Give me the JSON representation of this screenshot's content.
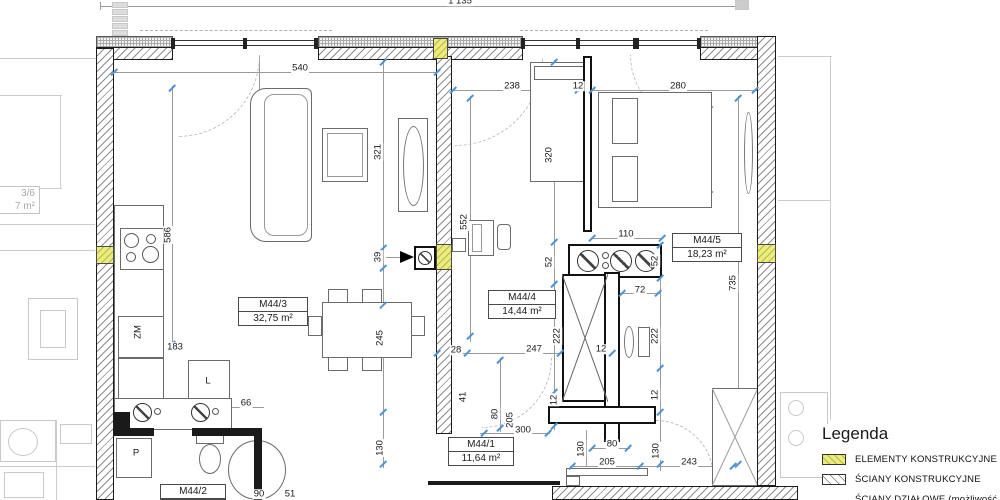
{
  "legend": {
    "title": "Legenda",
    "items": [
      {
        "label": "ELEMENTY KONSTRUKCYJNE",
        "swatch": "yellow-hatch"
      },
      {
        "label": "ŚCIANY KONSTRUKCYJNE",
        "swatch": "diagonal-hatch"
      },
      {
        "label": "ŚCIANY DZIAŁOWE (możliwość aranżacji)",
        "swatch": "light-hatch"
      }
    ]
  },
  "rooms": {
    "r1": {
      "name": "M44/1",
      "area": "11,64 m²"
    },
    "r2": {
      "name": "M44/2",
      "area": ""
    },
    "r3": {
      "name": "M44/3",
      "area": "32,75 m²"
    },
    "r4": {
      "name": "M44/4",
      "area": "14,44 m²"
    },
    "r5": {
      "name": "M44/5",
      "area": "18,23 m²"
    }
  },
  "neighbor": {
    "name": "3/6",
    "area": "7 m²"
  },
  "dims": {
    "total": "1 135",
    "d540": "540",
    "d238": "238",
    "d12a": "12",
    "d280": "280",
    "d110": "110",
    "d72": "72",
    "d28": "28",
    "d247": "247",
    "d12b": "12",
    "d183": "183",
    "d66": "66",
    "d300": "300",
    "d80h": "80",
    "d205h": "205",
    "d243": "243",
    "d90": "90",
    "d51": "51",
    "d321": "321",
    "d586": "586",
    "d39": "39",
    "d552": "552",
    "d320": "320",
    "d52a": "52",
    "d52b": "52",
    "d222a": "222",
    "d222b": "222",
    "d12c": "12",
    "d12d": "12",
    "d735": "735",
    "d245": "245",
    "d130a": "130",
    "d41": "41",
    "d80v": "80",
    "d205v": "205",
    "d130b": "130",
    "d130c": "130",
    "zm": "ZM",
    "l": "L",
    "p": "P"
  },
  "colors": {
    "structural_yellow": "#ecec7e",
    "tick_blue": "#4f93d6",
    "wall_line": "#1c1c1c",
    "neighbor_gray": "#c8c8c8"
  }
}
